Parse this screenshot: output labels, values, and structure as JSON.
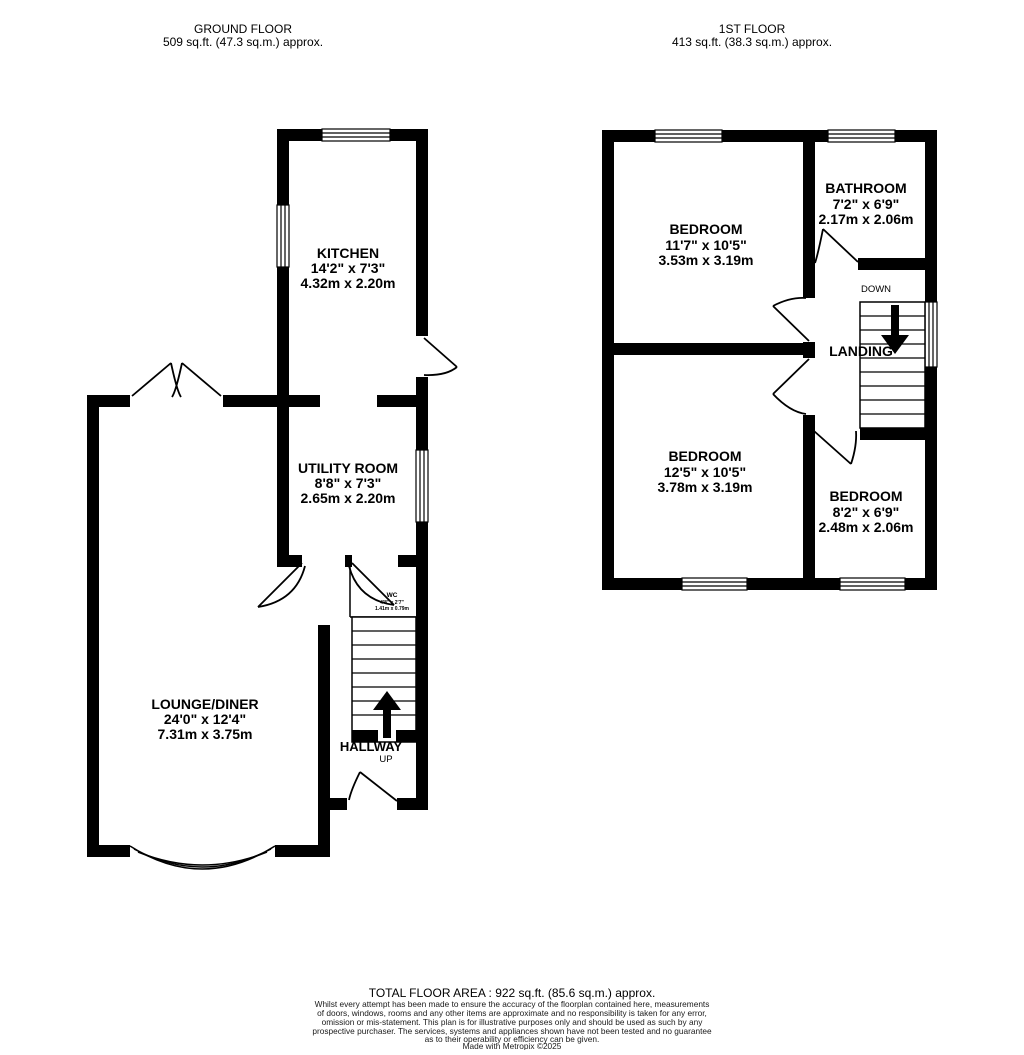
{
  "headers": {
    "ground": {
      "title": "GROUND FLOOR",
      "area": "509 sq.ft. (47.3 sq.m.) approx."
    },
    "first": {
      "title": "1ST FLOOR",
      "area": "413 sq.ft. (38.3 sq.m.) approx."
    }
  },
  "ground_floor": {
    "kitchen": {
      "name": "KITCHEN",
      "imperial": "14'2\"  x 7'3\"",
      "metric": "4.32m  x 2.20m"
    },
    "utility": {
      "name": "UTILITY ROOM",
      "imperial": "8'8\"  x 7'3\"",
      "metric": "2.65m  x 2.20m"
    },
    "lounge": {
      "name": "LOUNGE/DINER",
      "imperial": "24'0\"  x 12'4\"",
      "metric": "7.31m  x 3.75m"
    },
    "wc": {
      "name": "WC",
      "imperial": "4'8\"  x 2'7\"",
      "metric": "1.41m x 0.79m"
    },
    "hallway": {
      "name": "HALLWAY"
    },
    "stairs_direction": "UP"
  },
  "first_floor": {
    "bedroom1": {
      "name": "BEDROOM",
      "imperial": "11'7\"  x 10'5\"",
      "metric": "3.53m  x 3.19m"
    },
    "bathroom": {
      "name": "BATHROOM",
      "imperial": "7'2\"  x 6'9\"",
      "metric": "2.17m  x 2.06m"
    },
    "bedroom2": {
      "name": "BEDROOM",
      "imperial": "12'5\"  x 10'5\"",
      "metric": "3.78m  x 3.19m"
    },
    "bedroom3": {
      "name": "BEDROOM",
      "imperial": "8'2\"  x 6'9\"",
      "metric": "2.48m  x 2.06m"
    },
    "landing": {
      "name": "LANDING"
    },
    "stairs_direction": "DOWN"
  },
  "footer": {
    "total_area": "TOTAL FLOOR AREA : 922 sq.ft. (85.6 sq.m.) approx.",
    "disclaimer_lines": [
      "Whilst every attempt has been made to ensure the accuracy of the floorplan contained here, measurements",
      "of doors, windows, rooms and any other items are approximate and no responsibility is taken for any error,",
      "omission or mis-statement. This plan is for illustrative purposes only and should be used as such by any",
      "prospective purchaser. The services, systems and appliances shown have not been tested and no guarantee",
      "as to their operability or efficiency can be given."
    ],
    "credit": "Made with Metropix ©2025"
  },
  "colors": {
    "wall": "#000000",
    "background": "#ffffff"
  }
}
